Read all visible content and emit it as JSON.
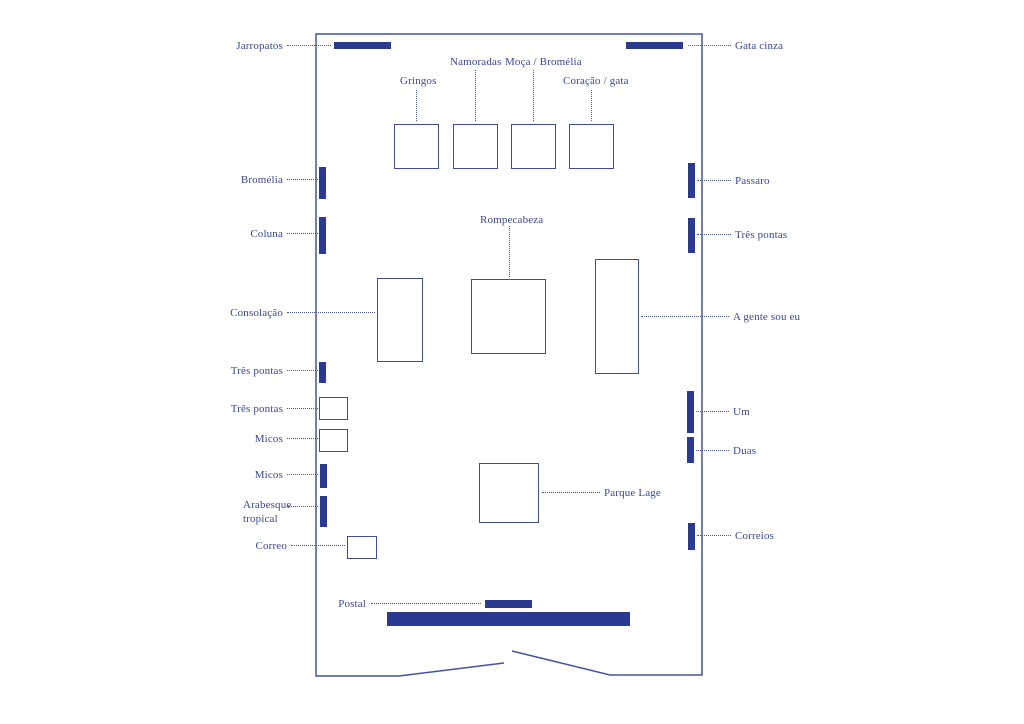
{
  "colors": {
    "ink": "#2b3990",
    "outline": "#3e4b9e",
    "wall": "#4753a0",
    "text": "#3a4695",
    "background": "#ffffff"
  },
  "plan": {
    "wall_path": "M504,663 L399,676 L316,676 L316,34 L702,34 L702,675 L610,675 L512,651",
    "labels": [
      {
        "name": "label-jarropatos",
        "text": "Jarropatos",
        "x": 283,
        "y": 39,
        "align": "right"
      },
      {
        "name": "label-gata-cinza",
        "text": "Gata cinza",
        "x": 735,
        "y": 39,
        "align": "left"
      },
      {
        "name": "label-gringos",
        "text": "Gringos",
        "x": 400,
        "y": 74,
        "align": "left"
      },
      {
        "name": "label-namoradas",
        "text": "Namoradas",
        "x": 450,
        "y": 55,
        "align": "left"
      },
      {
        "name": "label-moca-bromelia",
        "text": "Moça / Bromélia",
        "x": 505,
        "y": 55,
        "align": "left"
      },
      {
        "name": "label-coracao-gata",
        "text": "Coração / gata",
        "x": 563,
        "y": 74,
        "align": "left"
      },
      {
        "name": "label-bromelia",
        "text": "Bromélia",
        "x": 283,
        "y": 173,
        "align": "right"
      },
      {
        "name": "label-passaro",
        "text": "Passaro",
        "x": 735,
        "y": 174,
        "align": "left"
      },
      {
        "name": "label-rompecabeza",
        "text": "Rompecabeza",
        "x": 480,
        "y": 213,
        "align": "left"
      },
      {
        "name": "label-coluna",
        "text": "Coluna",
        "x": 283,
        "y": 227,
        "align": "right"
      },
      {
        "name": "label-tres-pontas-right",
        "text": "Três pontas",
        "x": 735,
        "y": 228,
        "align": "left"
      },
      {
        "name": "label-consolacao",
        "text": "Consolação",
        "x": 283,
        "y": 306,
        "align": "right"
      },
      {
        "name": "label-a-gente-sou-eu",
        "text": "A gente sou eu",
        "x": 733,
        "y": 310,
        "align": "left"
      },
      {
        "name": "label-tres-pontas-1",
        "text": "Três pontas",
        "x": 283,
        "y": 364,
        "align": "right"
      },
      {
        "name": "label-tres-pontas-2",
        "text": "Três pontas",
        "x": 283,
        "y": 402,
        "align": "right"
      },
      {
        "name": "label-um",
        "text": "Um",
        "x": 733,
        "y": 405,
        "align": "left"
      },
      {
        "name": "label-micos-1",
        "text": "Micos",
        "x": 283,
        "y": 432,
        "align": "right"
      },
      {
        "name": "label-duas",
        "text": "Duas",
        "x": 733,
        "y": 444,
        "align": "left"
      },
      {
        "name": "label-micos-2",
        "text": "Micos",
        "x": 283,
        "y": 468,
        "align": "right"
      },
      {
        "name": "label-parque-lage",
        "text": "Parque Lage",
        "x": 604,
        "y": 486,
        "align": "left"
      },
      {
        "name": "label-arabesque-tropical",
        "text": "Arabesque\ntropical",
        "x": 243,
        "y": 498,
        "align": "left"
      },
      {
        "name": "label-correios",
        "text": "Correios",
        "x": 735,
        "y": 529,
        "align": "left"
      },
      {
        "name": "label-correo",
        "text": "Correo",
        "x": 287,
        "y": 539,
        "align": "right"
      },
      {
        "name": "label-postal",
        "text": "Postal",
        "x": 366,
        "y": 597,
        "align": "right"
      }
    ],
    "bars": [
      {
        "name": "wall-piece-jarropatos",
        "x": 334,
        "y": 42,
        "w": 57,
        "h": 7
      },
      {
        "name": "wall-piece-gata-cinza",
        "x": 626,
        "y": 42,
        "w": 57,
        "h": 7
      },
      {
        "name": "wall-piece-bromelia",
        "x": 319,
        "y": 167,
        "w": 7,
        "h": 32
      },
      {
        "name": "wall-piece-passaro",
        "x": 688,
        "y": 163,
        "w": 7,
        "h": 35
      },
      {
        "name": "wall-piece-coluna",
        "x": 319,
        "y": 217,
        "w": 7,
        "h": 37
      },
      {
        "name": "wall-piece-tres-pontas-right",
        "x": 688,
        "y": 218,
        "w": 7,
        "h": 35
      },
      {
        "name": "wall-piece-tres-pontas-1",
        "x": 319,
        "y": 362,
        "w": 7,
        "h": 21
      },
      {
        "name": "wall-piece-um",
        "x": 687,
        "y": 391,
        "w": 7,
        "h": 42
      },
      {
        "name": "wall-piece-duas",
        "x": 687,
        "y": 437,
        "w": 7,
        "h": 26
      },
      {
        "name": "wall-piece-micos-2",
        "x": 320,
        "y": 464,
        "w": 7,
        "h": 24
      },
      {
        "name": "wall-piece-arabesque",
        "x": 320,
        "y": 496,
        "w": 7,
        "h": 31
      },
      {
        "name": "wall-piece-correios",
        "x": 688,
        "y": 523,
        "w": 7,
        "h": 27
      },
      {
        "name": "wall-piece-postal",
        "x": 485,
        "y": 600,
        "w": 47,
        "h": 8
      },
      {
        "name": "wall-piece-bottom-large",
        "x": 387,
        "y": 612,
        "w": 243,
        "h": 14
      }
    ],
    "rects": [
      {
        "name": "pedestal-gringos",
        "x": 394,
        "y": 124,
        "w": 45,
        "h": 45
      },
      {
        "name": "pedestal-namoradas",
        "x": 453,
        "y": 124,
        "w": 45,
        "h": 45
      },
      {
        "name": "pedestal-moca-bromelia",
        "x": 511,
        "y": 124,
        "w": 45,
        "h": 45
      },
      {
        "name": "pedestal-coracao-gata",
        "x": 569,
        "y": 124,
        "w": 45,
        "h": 45
      },
      {
        "name": "pedestal-consolacao",
        "x": 377,
        "y": 278,
        "w": 46,
        "h": 84
      },
      {
        "name": "pedestal-rompecabeza",
        "x": 471,
        "y": 279,
        "w": 75,
        "h": 75
      },
      {
        "name": "pedestal-a-gente-sou-eu",
        "x": 595,
        "y": 259,
        "w": 44,
        "h": 115
      },
      {
        "name": "pedestal-tres-pontas-2",
        "x": 319,
        "y": 397,
        "w": 29,
        "h": 23
      },
      {
        "name": "pedestal-micos-1",
        "x": 319,
        "y": 429,
        "w": 29,
        "h": 23
      },
      {
        "name": "pedestal-parque-lage",
        "x": 479,
        "y": 463,
        "w": 60,
        "h": 60
      },
      {
        "name": "pedestal-correo",
        "x": 347,
        "y": 536,
        "w": 30,
        "h": 23
      }
    ],
    "leaders": [
      {
        "name": "leader-jarropatos",
        "o": "h",
        "x": 287,
        "y": 45,
        "len": 44
      },
      {
        "name": "leader-gata-cinza",
        "o": "h",
        "x": 688,
        "y": 45,
        "len": 43
      },
      {
        "name": "leader-gringos",
        "o": "v",
        "x": 416,
        "y": 90,
        "len": 31
      },
      {
        "name": "leader-namoradas",
        "o": "v",
        "x": 475,
        "y": 70,
        "len": 51
      },
      {
        "name": "leader-moca-bromelia",
        "o": "v",
        "x": 533,
        "y": 70,
        "len": 51
      },
      {
        "name": "leader-coracao-gata",
        "o": "v",
        "x": 591,
        "y": 90,
        "len": 31
      },
      {
        "name": "leader-bromelia",
        "o": "h",
        "x": 287,
        "y": 179,
        "len": 31
      },
      {
        "name": "leader-passaro",
        "o": "h",
        "x": 697,
        "y": 180,
        "len": 34
      },
      {
        "name": "leader-rompecabeza",
        "o": "v",
        "x": 509,
        "y": 226,
        "len": 51
      },
      {
        "name": "leader-coluna",
        "o": "h",
        "x": 287,
        "y": 233,
        "len": 31
      },
      {
        "name": "leader-tres-pontas-right",
        "o": "h",
        "x": 697,
        "y": 234,
        "len": 34
      },
      {
        "name": "leader-consolacao",
        "o": "h",
        "x": 287,
        "y": 312,
        "len": 88
      },
      {
        "name": "leader-a-gente-sou-eu",
        "o": "h",
        "x": 641,
        "y": 316,
        "len": 88
      },
      {
        "name": "leader-tres-pontas-1",
        "o": "h",
        "x": 287,
        "y": 370,
        "len": 31
      },
      {
        "name": "leader-tres-pontas-2",
        "o": "h",
        "x": 287,
        "y": 408,
        "len": 31
      },
      {
        "name": "leader-um",
        "o": "h",
        "x": 696,
        "y": 411,
        "len": 33
      },
      {
        "name": "leader-micos-1",
        "o": "h",
        "x": 287,
        "y": 438,
        "len": 31
      },
      {
        "name": "leader-duas",
        "o": "h",
        "x": 696,
        "y": 450,
        "len": 33
      },
      {
        "name": "leader-micos-2",
        "o": "h",
        "x": 287,
        "y": 474,
        "len": 31
      },
      {
        "name": "leader-parque-lage",
        "o": "h",
        "x": 542,
        "y": 492,
        "len": 58
      },
      {
        "name": "leader-arabesque",
        "o": "h",
        "x": 288,
        "y": 506,
        "len": 30
      },
      {
        "name": "leader-correios",
        "o": "h",
        "x": 697,
        "y": 535,
        "len": 34
      },
      {
        "name": "leader-correo",
        "o": "h",
        "x": 291,
        "y": 545,
        "len": 54
      },
      {
        "name": "leader-postal",
        "o": "h",
        "x": 371,
        "y": 603,
        "len": 110
      }
    ]
  }
}
